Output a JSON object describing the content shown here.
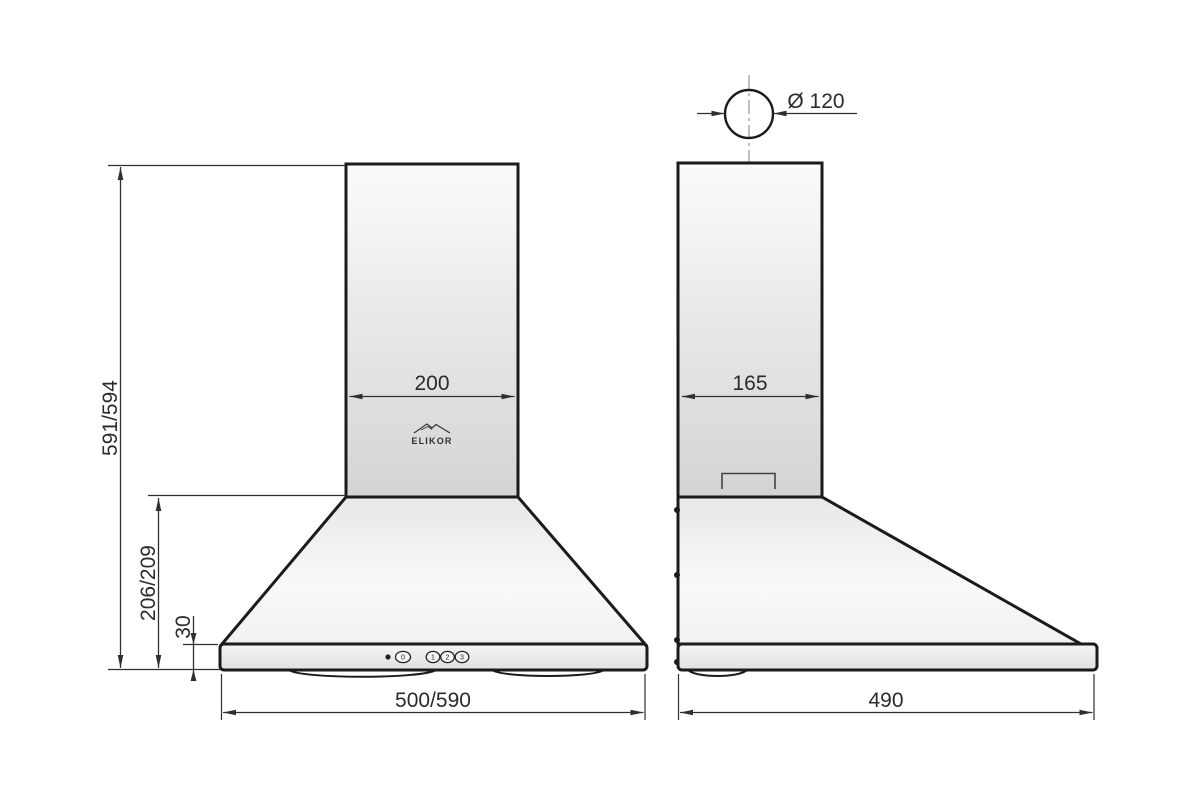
{
  "drawing": {
    "brand": "ELIKOR",
    "views": {
      "front": {
        "duct_width": "200",
        "body_width": "500/590",
        "total_height": "591/594",
        "canopy_height": "206/209",
        "base_height": "30",
        "buttons": {
          "power": "0",
          "speed1": "1",
          "speed2": "2",
          "speed3": "3"
        }
      },
      "side": {
        "duct_depth": "165",
        "body_depth": "490",
        "outlet_diameter": "Ø 120"
      }
    },
    "colors": {
      "outline": "#1b1b1b",
      "dimension": "#2f2f2f",
      "centerline": "#9aa0a2",
      "background": "#ffffff"
    }
  }
}
